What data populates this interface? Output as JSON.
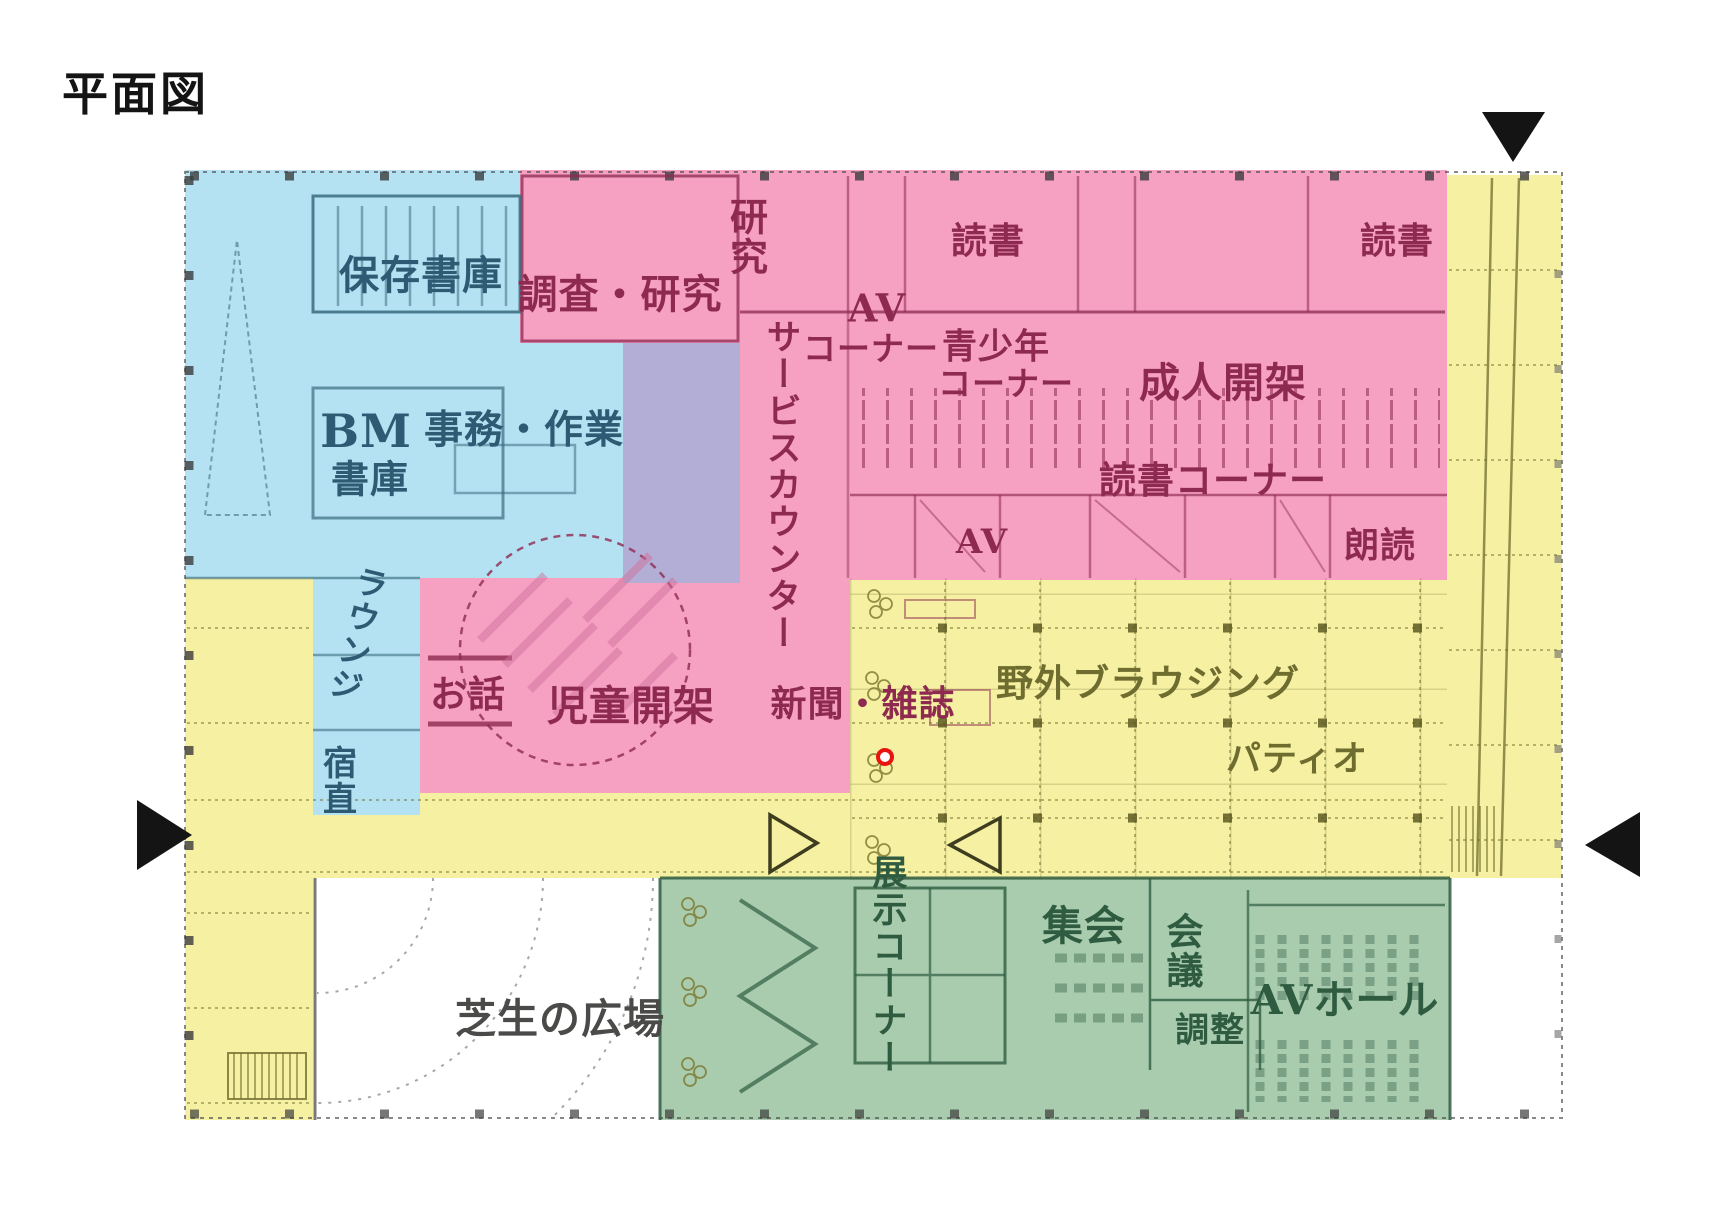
{
  "title": "平面図",
  "colors": {
    "pink": "#f6a0c2",
    "blue": "#b5e2f2",
    "yellow": "#f5f0a2",
    "green": "#a9cbae",
    "lavender": "#b2aed6",
    "pink-dark": "#8e2a50",
    "blue-dark": "#2e5b74",
    "yellow-dark": "#6e6c2e",
    "green-dark": "#2f5c41",
    "plaza-text": "#4a4a48",
    "marker-red": "#e8150f",
    "marker-black": "#141414"
  },
  "rooms": {
    "hozon_shoko": "保存書庫",
    "chosa_kenkyu": "調査・研究",
    "kenkyu": "研究",
    "dokusho_mid": "読書",
    "dokusho_right": "読書",
    "av_corner_1": "AV",
    "av_corner_2": "コーナー",
    "seishonen_1": "青少年",
    "seishonen_2": "コーナー",
    "seijin_kaika": "成人開架",
    "dokusho_corner": "読書コーナー",
    "av_room": "AV",
    "rodoku": "朗読",
    "service_counter": "サービスカウンター",
    "bm_1": "BM",
    "bm_2": "書庫",
    "jimu_sagyo": "事務・作業",
    "lounge": "ラウンジ",
    "shukuchoku": "宿直",
    "ohanashi": "お話",
    "jido_kaika": "児童開架",
    "shinbun_zasshi": "新聞・雑誌",
    "yagai_browsing": "野外ブラウジング",
    "patio": "パティオ",
    "tenji_corner": "展示コーナー",
    "shukai": "集会",
    "kaigi": "会議",
    "chosei": "調整",
    "av_hall": "AVホール",
    "shibafu_hiroba": "芝生の広場"
  }
}
